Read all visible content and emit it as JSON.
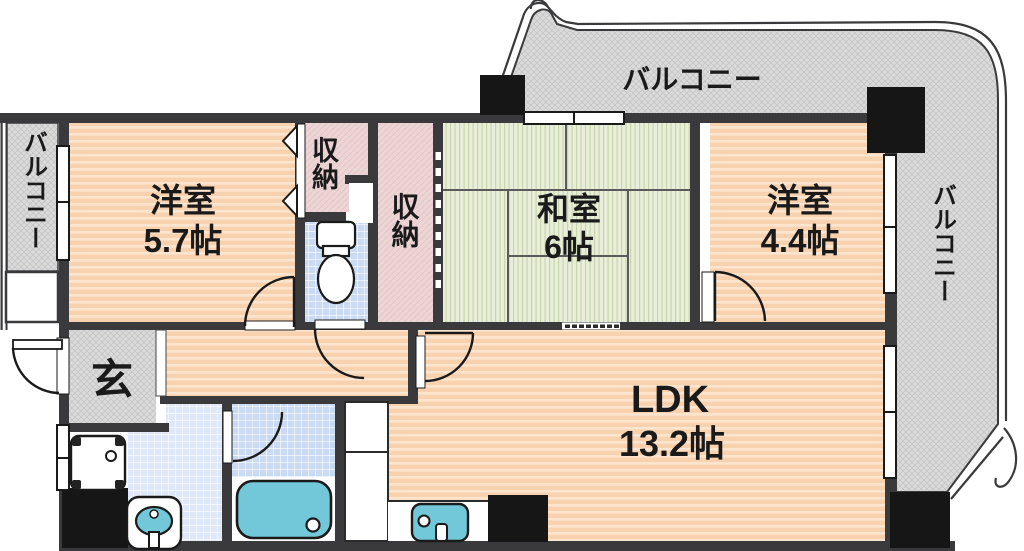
{
  "floorplan": {
    "labels": {
      "balcony_top": "バルコニー",
      "balcony_left": "バルコニー",
      "balcony_right": "バルコニー",
      "western_room_1_name": "洋室",
      "western_room_1_size": "5.7帖",
      "western_room_2_name": "洋室",
      "western_room_2_size": "4.4帖",
      "japanese_room_name": "和室",
      "japanese_room_size": "6帖",
      "ldk_name": "LDK",
      "ldk_size": "13.2帖",
      "storage_1": "収納",
      "storage_2": "収納",
      "entrance": "玄"
    },
    "colors": {
      "wall": "#3a3a3c",
      "flooring": "#f8d2ae",
      "flooring_stripe": "#fce5cf",
      "tatami": "#e9eedb",
      "tatami_stripe": "#c9d6ad",
      "closet": "#edd5d6",
      "tile": "#c9daf2",
      "tile_light": "#dfe8f8",
      "balcony": "#dbdbdb",
      "fixture_teal": "#72c8d8",
      "pillar": "#161616"
    }
  }
}
